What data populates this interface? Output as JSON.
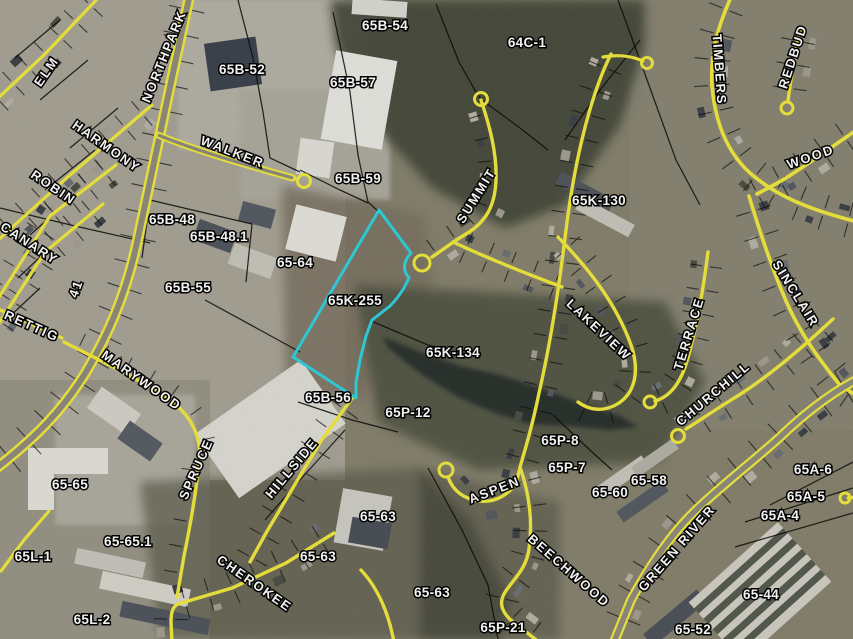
{
  "map": {
    "highlighted_parcel": "65K-255",
    "highlight_color": "#2ed2df",
    "road_line_color": "#f0e93e",
    "parcel_line_color": "#000000",
    "label_color": "#ffffff"
  },
  "parcel_labels": [
    {
      "text": "65B-54",
      "x": 385,
      "y": 26
    },
    {
      "text": "64C-1",
      "x": 527,
      "y": 43
    },
    {
      "text": "65B-52",
      "x": 242,
      "y": 70
    },
    {
      "text": "65B-57",
      "x": 353,
      "y": 83
    },
    {
      "text": "65B-59",
      "x": 358,
      "y": 179
    },
    {
      "text": "65K-130",
      "x": 599,
      "y": 201
    },
    {
      "text": "65B-48",
      "x": 172,
      "y": 220
    },
    {
      "text": "65B-48.1",
      "x": 219,
      "y": 237
    },
    {
      "text": "65-64",
      "x": 295,
      "y": 263
    },
    {
      "text": "65B-55",
      "x": 188,
      "y": 288
    },
    {
      "text": "65K-255",
      "x": 355,
      "y": 301
    },
    {
      "text": "65K-134",
      "x": 453,
      "y": 353
    },
    {
      "text": "65B-56",
      "x": 328,
      "y": 398
    },
    {
      "text": "65P-12",
      "x": 408,
      "y": 413
    },
    {
      "text": "65P-8",
      "x": 560,
      "y": 441
    },
    {
      "text": "65P-7",
      "x": 567,
      "y": 468
    },
    {
      "text": "65-58",
      "x": 649,
      "y": 481
    },
    {
      "text": "65-60",
      "x": 610,
      "y": 493
    },
    {
      "text": "65A-6",
      "x": 813,
      "y": 470
    },
    {
      "text": "65A-5",
      "x": 806,
      "y": 497
    },
    {
      "text": "65A-4",
      "x": 780,
      "y": 516
    },
    {
      "text": "65-65",
      "x": 70,
      "y": 485
    },
    {
      "text": "65-65.1",
      "x": 128,
      "y": 542
    },
    {
      "text": "65L-1",
      "x": 33,
      "y": 557
    },
    {
      "text": "65-63",
      "x": 378,
      "y": 517
    },
    {
      "text": "65-63",
      "x": 318,
      "y": 557
    },
    {
      "text": "65-63",
      "x": 432,
      "y": 593
    },
    {
      "text": "65L-2",
      "x": 92,
      "y": 620
    },
    {
      "text": "65P-21",
      "x": 503,
      "y": 628
    },
    {
      "text": "65-44",
      "x": 761,
      "y": 595
    },
    {
      "text": "65-52",
      "x": 693,
      "y": 630
    }
  ],
  "street_labels": [
    {
      "text": "ELM",
      "x": 50,
      "y": 74,
      "rot": -55
    },
    {
      "text": "NORTHPARK",
      "x": 168,
      "y": 58,
      "rot": -68
    },
    {
      "text": "HARMONY",
      "x": 104,
      "y": 150,
      "rot": 35
    },
    {
      "text": "WALKER",
      "x": 231,
      "y": 156,
      "rot": 21
    },
    {
      "text": "ROBIN",
      "x": 51,
      "y": 191,
      "rot": 34
    },
    {
      "text": "CANARY",
      "x": 27,
      "y": 247,
      "rot": 33
    },
    {
      "text": "41",
      "x": 80,
      "y": 290,
      "rot": -70
    },
    {
      "text": "RETTIG",
      "x": 30,
      "y": 330,
      "rot": 24
    },
    {
      "text": "MARYWOOD",
      "x": 139,
      "y": 384,
      "rot": 35
    },
    {
      "text": "SPRUCE",
      "x": 200,
      "y": 471,
      "rot": -66
    },
    {
      "text": "HILLSIDE",
      "x": 295,
      "y": 471,
      "rot": -50
    },
    {
      "text": "CHEROKEE",
      "x": 252,
      "y": 587,
      "rot": 35
    },
    {
      "text": "SUMMIT",
      "x": 480,
      "y": 198,
      "rot": -58
    },
    {
      "text": "LAKEVIEW",
      "x": 596,
      "y": 333,
      "rot": 43
    },
    {
      "text": "TERRACE",
      "x": 693,
      "y": 335,
      "rot": -73
    },
    {
      "text": "SINCLAIR",
      "x": 792,
      "y": 296,
      "rot": 58
    },
    {
      "text": "CHURCHILL",
      "x": 716,
      "y": 397,
      "rot": -40
    },
    {
      "text": "REDBUD",
      "x": 797,
      "y": 58,
      "rot": -72
    },
    {
      "text": "TIMBERS",
      "x": 715,
      "y": 70,
      "rot": 86
    },
    {
      "text": "WOOD",
      "x": 812,
      "y": 161,
      "rot": -19
    },
    {
      "text": "GREEN RIVER",
      "x": 680,
      "y": 551,
      "rot": -49
    },
    {
      "text": "BEECHWOOD",
      "x": 566,
      "y": 574,
      "rot": 41
    },
    {
      "text": "ASPEN",
      "x": 496,
      "y": 494,
      "rot": -21
    }
  ]
}
